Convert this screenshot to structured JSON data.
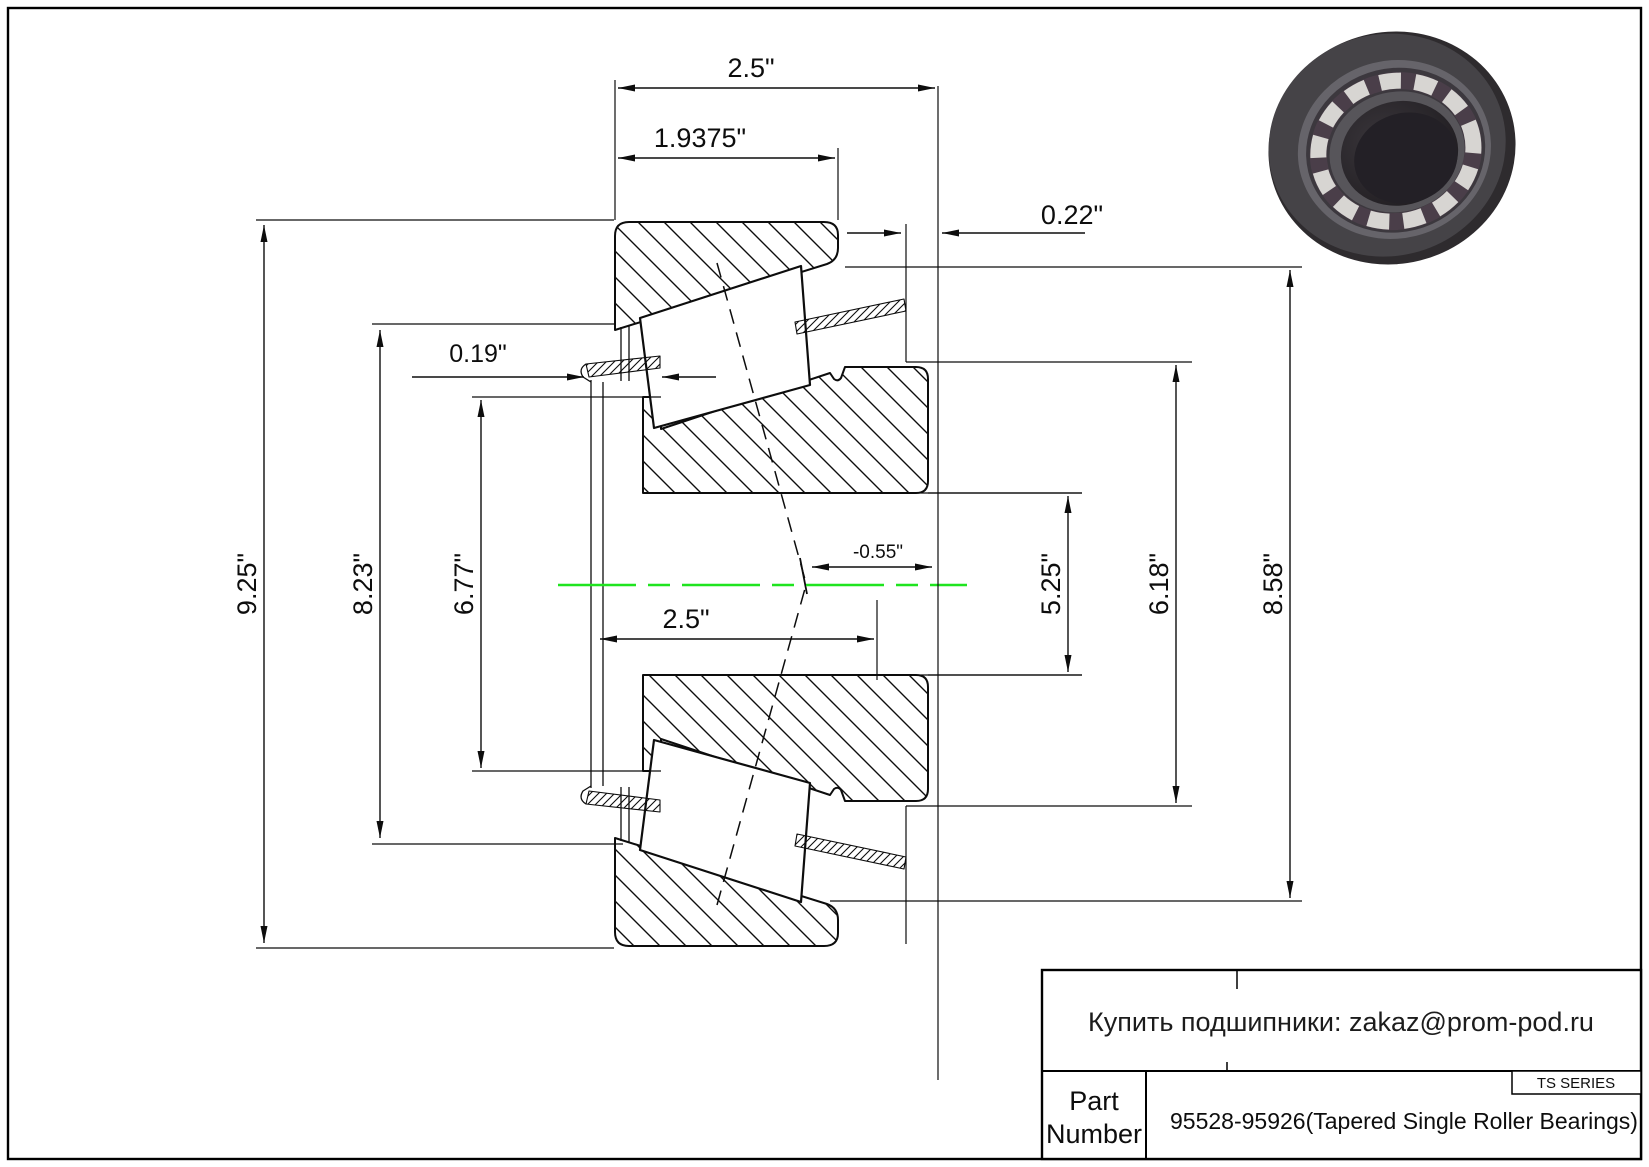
{
  "drawing": {
    "dimensions": {
      "overall_width_top": "2.5\"",
      "cup_width": "1.9375\"",
      "cone_standout": "0.22\"",
      "cage_lip": "0.19\"",
      "outer_diameter": "9.25\"",
      "diameter_8_23": "8.23\"",
      "diameter_6_77": "6.77\"",
      "bore_width": "2.5\"",
      "effective_center": "-0.55\"",
      "bore_diameter": "5.25\"",
      "diameter_6_18": "6.18\"",
      "diameter_8_58": "8.58\""
    },
    "colors": {
      "centerline": "#1fe41f",
      "line": "#0d0d0d",
      "bearing_body": "#454347",
      "bearing_rim": "#66646a",
      "roller_light": "#d7d5d2"
    }
  },
  "title_block": {
    "contact": "Купить подшипники: zakaz@prom-pod.ru",
    "series": "TS SERIES",
    "part_label_line1": "Part",
    "part_label_line2": "Number",
    "part_number": "95528-95926(Tapered Single Roller Bearings)"
  }
}
